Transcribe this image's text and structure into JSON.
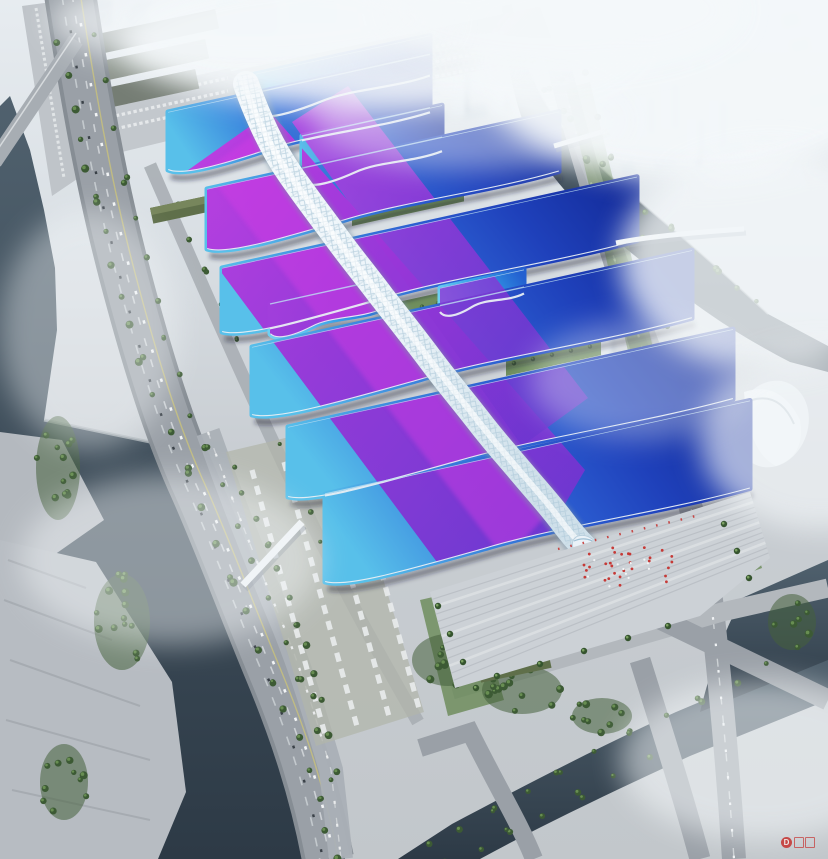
{
  "image": {
    "type": "aerial architectural rendering",
    "subject": "large exhibition and convention center complex with a white serpentine central concourse spanning rows of wave-edged exhibition halls",
    "view": "oblique bird's-eye view, complex running diagonally from upper left to lower center",
    "atmosphere": "photorealistic render with white haze and fog over the distant city"
  },
  "watermark": {
    "badge_letter": "D",
    "color": "#c53a30"
  },
  "palette": {
    "haze": "#eef3f6",
    "ground": "#c2c7cb",
    "road": "#9aa0a7",
    "road_light": "#aab0b6",
    "water_dark": "#2d3a46",
    "water_mid": "#50616e",
    "tree_green": "#3c5a34",
    "tree_light": "#6d9355",
    "lawn_green": "#5d8046",
    "hall_cyan": "#58c0ea",
    "hall_blue": "#2b5cd0",
    "hall_deep": "#152e9e",
    "ribbon_magenta": "#c93ae2",
    "ribbon_violet": "#6c35cf",
    "spine_white": "#ecf4f9",
    "spine_shadow": "#7c95a8",
    "plaza": "#ccd1d6",
    "crowd_red": "#c5312e",
    "city_block": "#e3e9ee",
    "olive_shed": "#5f6f4a"
  },
  "scene": {
    "hall_rows": 7,
    "annex_halls": 2,
    "central_spine": "serpentine white concourse with diamond-grid roof",
    "landmarks": [
      "car parking lots (north-west)",
      "bus depots",
      "riverside expressway bridge (west)",
      "bus staging lots with white buses",
      "east ring road",
      "meandering river with footbridges (east)",
      "south entrance plaza with steps, palm trees and visitor crowd",
      "white sail-roof landmark building (east)",
      "distant city towers in haze",
      "south water channel with road bridges"
    ]
  }
}
